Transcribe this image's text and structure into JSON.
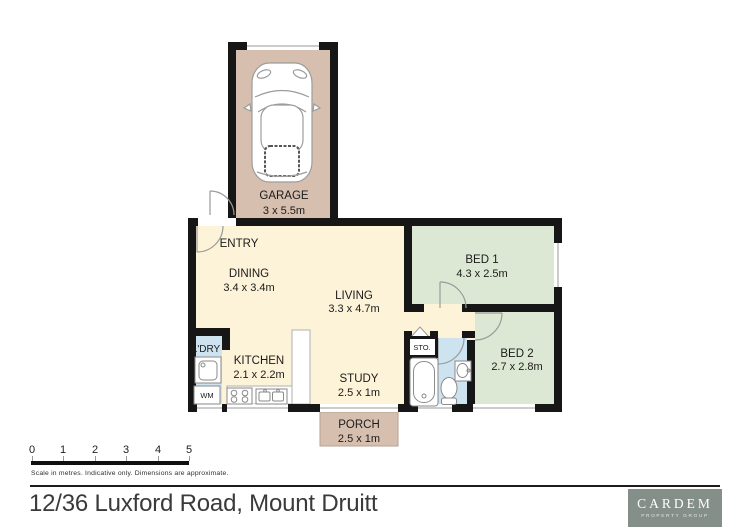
{
  "floorplan": {
    "rooms": {
      "garage": {
        "label": "GARAGE",
        "dims": "3 x 5.5m"
      },
      "entry": {
        "label": "ENTRY"
      },
      "dining": {
        "label": "DINING",
        "dims": "3.4 x 3.4m"
      },
      "living": {
        "label": "LIVING",
        "dims": "3.3 x 4.7m"
      },
      "bed1": {
        "label": "BED 1",
        "dims": "4.3 x 2.5m"
      },
      "bed2": {
        "label": "BED 2",
        "dims": "2.7 x 2.8m"
      },
      "kitchen": {
        "label": "KITCHEN",
        "dims": "2.1 x 2.2m"
      },
      "study": {
        "label": "STUDY",
        "dims": "2.5 x 1m"
      },
      "porch": {
        "label": "PORCH",
        "dims": "2.5 x 1m"
      },
      "laundry": {
        "label": "L'DRY"
      },
      "storage": {
        "label": "STO."
      },
      "washing_machine": {
        "label": "WM"
      }
    },
    "colors": {
      "wall": "#161616",
      "floor_cream": "#fdf3d8",
      "garage_tan": "#d6bfaf",
      "bedroom_green": "#dde8d4",
      "bath_blue": "#cde3ef",
      "fixture_white": "#ffffff"
    }
  },
  "scale_bar": {
    "ticks": [
      "0",
      "1",
      "2",
      "3",
      "4",
      "5"
    ],
    "caption": "Scale in metres. Indicative only. Dimensions are approximate."
  },
  "footer": {
    "address": "12/36 Luxford Road, Mount Druitt"
  },
  "logo": {
    "brand": "CARDEM",
    "tagline": "PROPERTY GROUP"
  }
}
